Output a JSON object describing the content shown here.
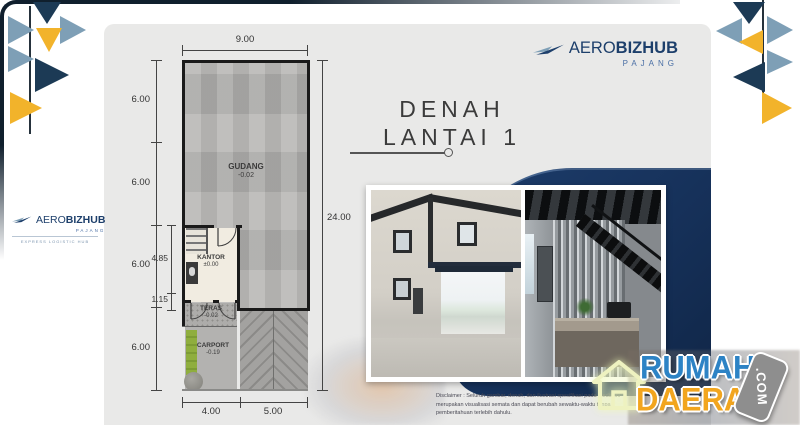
{
  "brand": {
    "name_a": "AERO",
    "name_b": "BIZHUB",
    "sub": "PAJANG",
    "tagline": "EXPRESS LOGISTIC HUB"
  },
  "title": {
    "line1": "DENAH",
    "line2": "LANTAI 1"
  },
  "floorplan": {
    "dim_top": "9.00",
    "dim_right": "24.00",
    "left_dims": [
      "6.00",
      "6.00",
      "6.00",
      "6.00"
    ],
    "inner_dims": {
      "kantor": "4.85",
      "teras": "1.15"
    },
    "bottom_dims": [
      "4.00",
      "5.00"
    ],
    "rooms": {
      "gudang": {
        "name": "GUDANG",
        "elev": "-0.02"
      },
      "kantor": {
        "name": "KANTOR",
        "elev": "±0.00"
      },
      "teras": {
        "name": "TERAS",
        "elev": "-0.02"
      },
      "carport": {
        "name": "CARPORT",
        "elev": "-0.19"
      }
    }
  },
  "disclaimer": "Disclaimer : Seluruh gambar, denah, dan ilustrasi spesifikasi pada media ini merupakan visualisasi semata dan dapat berubah sewaktu-waktu tanpa pemberitahuan terlebih dahulu.",
  "watermark": {
    "word1": "RUMAH",
    "word2": "DAERAH",
    "badge": ".COM"
  },
  "colors": {
    "navy": "#1c3a55",
    "steel": "#7e9fb6",
    "yellow": "#f2b32b",
    "panel": "#16315a",
    "card": "#e9e9e8",
    "brand_navy": "#1d3f6b",
    "wm_blue": "#2d83c5",
    "wm_orange": "#f2a51e"
  }
}
